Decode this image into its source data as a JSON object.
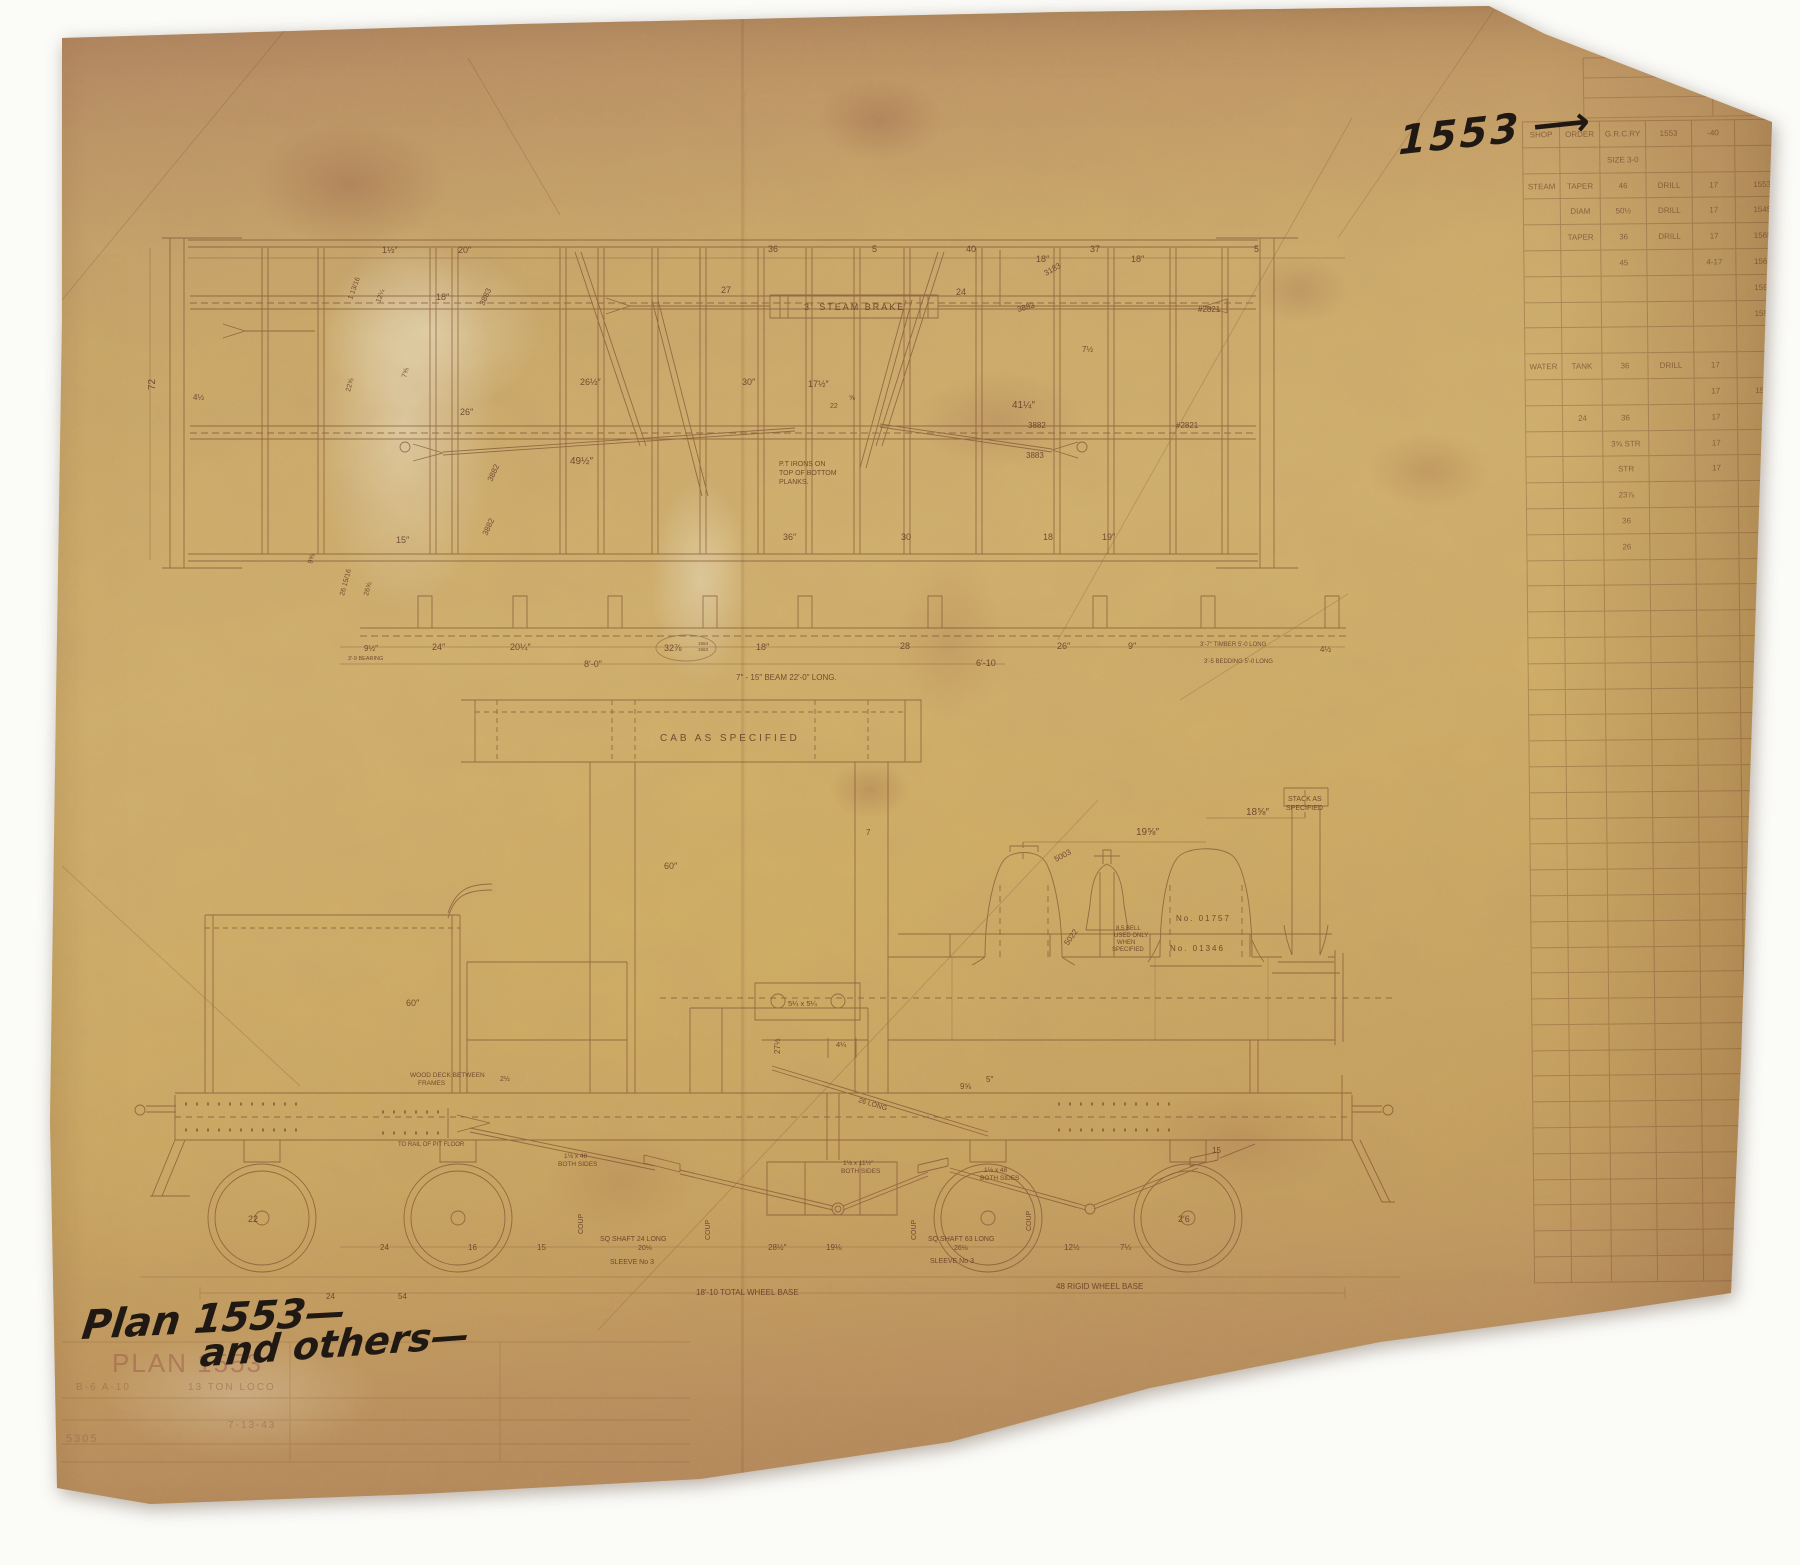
{
  "annotations": {
    "top_right_number": "1553",
    "top_right_arrow": "⟶",
    "bottom_left_line1": "Plan 1553—",
    "bottom_left_line2": "and others—"
  },
  "title_block": {
    "labels": [
      {
        "t": "PLAN 1553",
        "x": 112,
        "y": 1372,
        "s": 26,
        "ls": 6
      },
      {
        "t": "B-6 A-10",
        "x": 76,
        "y": 1390,
        "s": 10
      },
      {
        "t": "13 TON LOCO",
        "x": 188,
        "y": 1390,
        "s": 10,
        "ls": 3
      },
      {
        "t": "7-13-43",
        "x": 228,
        "y": 1428,
        "s": 10
      },
      {
        "t": "5305",
        "x": 66,
        "y": 1442,
        "s": 11
      }
    ]
  },
  "plan_view": {
    "labels": [
      {
        "t": "1½″",
        "x": 382,
        "y": 253
      },
      {
        "t": "20″",
        "x": 458,
        "y": 253
      },
      {
        "t": "36",
        "x": 768,
        "y": 252
      },
      {
        "t": "5",
        "x": 872,
        "y": 252
      },
      {
        "t": "40",
        "x": 966,
        "y": 252
      },
      {
        "t": "37",
        "x": 1090,
        "y": 252
      },
      {
        "t": "5",
        "x": 1254,
        "y": 252
      },
      {
        "t": "18″",
        "x": 436,
        "y": 300
      },
      {
        "t": "27",
        "x": 721,
        "y": 293
      },
      {
        "t": "3′ STEAM BRAKE",
        "x": 804,
        "y": 310,
        "ls": 2
      },
      {
        "t": "24",
        "x": 956,
        "y": 295
      },
      {
        "t": "18″",
        "x": 1036,
        "y": 262
      },
      {
        "t": "18″",
        "x": 1131,
        "y": 262
      },
      {
        "t": "3183",
        "x": 1046,
        "y": 276,
        "r": -30,
        "s": 8
      },
      {
        "t": "3883",
        "x": 484,
        "y": 306,
        "r": -65,
        "s": 8
      },
      {
        "t": "3883",
        "x": 1018,
        "y": 312,
        "r": -15,
        "s": 8
      },
      {
        "t": "#2821",
        "x": 1198,
        "y": 312,
        "s": 8
      },
      {
        "t": "1 13/16",
        "x": 352,
        "y": 300,
        "r": -70,
        "s": 7
      },
      {
        "t": "12¼",
        "x": 380,
        "y": 303,
        "r": -70,
        "s": 7
      },
      {
        "t": "72",
        "x": 155,
        "y": 390,
        "r": -90,
        "s": 10
      },
      {
        "t": "4½",
        "x": 193,
        "y": 400,
        "s": 8
      },
      {
        "t": "7⅝",
        "x": 406,
        "y": 378,
        "r": -75,
        "s": 7
      },
      {
        "t": "22⅝",
        "x": 350,
        "y": 392,
        "r": -75,
        "s": 7
      },
      {
        "t": "26½″",
        "x": 580,
        "y": 385
      },
      {
        "t": "30″",
        "x": 742,
        "y": 385
      },
      {
        "t": "17½″",
        "x": 808,
        "y": 387
      },
      {
        "t": "22",
        "x": 830,
        "y": 408,
        "s": 7
      },
      {
        "t": "⅝",
        "x": 849,
        "y": 400,
        "s": 7
      },
      {
        "t": "7½",
        "x": 1082,
        "y": 352,
        "s": 8
      },
      {
        "t": "26″",
        "x": 460,
        "y": 415
      },
      {
        "t": "49½″",
        "x": 570,
        "y": 464,
        "s": 10
      },
      {
        "t": "41¼″",
        "x": 1012,
        "y": 408,
        "s": 10
      },
      {
        "t": "P.T IRONS ON",
        "x": 779,
        "y": 466,
        "s": 7
      },
      {
        "t": "TOP OF BOTTOM",
        "x": 779,
        "y": 475,
        "s": 7
      },
      {
        "t": "PLANKS.",
        "x": 779,
        "y": 484,
        "s": 7
      },
      {
        "t": "3882",
        "x": 492,
        "y": 482,
        "r": -65,
        "s": 8
      },
      {
        "t": "3882",
        "x": 487,
        "y": 536,
        "r": -65,
        "s": 8
      },
      {
        "t": "3882",
        "x": 1028,
        "y": 428,
        "s": 8
      },
      {
        "t": "3883",
        "x": 1026,
        "y": 458,
        "s": 8
      },
      {
        "t": "#2821",
        "x": 1176,
        "y": 428,
        "s": 8
      },
      {
        "t": "15″",
        "x": 396,
        "y": 543
      },
      {
        "t": "36″",
        "x": 783,
        "y": 540
      },
      {
        "t": "30",
        "x": 901,
        "y": 540
      },
      {
        "t": "18",
        "x": 1043,
        "y": 540
      },
      {
        "t": "19″",
        "x": 1102,
        "y": 540
      },
      {
        "t": "9⅝",
        "x": 312,
        "y": 564,
        "r": -75,
        "s": 7
      },
      {
        "t": "26 15/16",
        "x": 344,
        "y": 596,
        "r": -75,
        "s": 7
      },
      {
        "t": "26⅝",
        "x": 368,
        "y": 596,
        "r": -75,
        "s": 7
      },
      {
        "t": "3′-9 BEARING",
        "x": 348,
        "y": 660,
        "s": 5.5
      },
      {
        "t": "9½″",
        "x": 364,
        "y": 651,
        "s": 8
      },
      {
        "t": "24″",
        "x": 432,
        "y": 650
      },
      {
        "t": "20¼″",
        "x": 510,
        "y": 650
      },
      {
        "t": "8′-0″",
        "x": 584,
        "y": 667
      },
      {
        "t": "32⅞",
        "x": 664,
        "y": 651
      },
      {
        "t": "1554",
        "x": 698,
        "y": 645,
        "s": 4.5
      },
      {
        "t": "1563",
        "x": 698,
        "y": 651,
        "s": 4.5
      },
      {
        "t": "18″",
        "x": 756,
        "y": 650
      },
      {
        "t": "28",
        "x": 900,
        "y": 649
      },
      {
        "t": "6′-10",
        "x": 976,
        "y": 666
      },
      {
        "t": "26″",
        "x": 1057,
        "y": 649
      },
      {
        "t": "9″",
        "x": 1128,
        "y": 649
      },
      {
        "t": "3′-7″ TIMBER 5′-0 LONG",
        "x": 1200,
        "y": 646,
        "s": 6
      },
      {
        "t": "3′-5 BEDDING 5′-0 LONG",
        "x": 1204,
        "y": 663,
        "s": 6
      },
      {
        "t": "4½",
        "x": 1320,
        "y": 652,
        "s": 8
      },
      {
        "t": "7″ - 15″ BEAM 22′-0″ LONG.",
        "x": 736,
        "y": 680,
        "s": 8
      }
    ]
  },
  "elevation": {
    "labels": [
      {
        "t": "CAB AS SPECIFIED",
        "x": 660,
        "y": 741,
        "s": 10,
        "ls": 3
      },
      {
        "t": "60″",
        "x": 664,
        "y": 869
      },
      {
        "t": "7",
        "x": 866,
        "y": 835,
        "s": 8
      },
      {
        "t": "STACK AS",
        "x": 1288,
        "y": 801,
        "s": 7
      },
      {
        "t": "SPECIFIED",
        "x": 1286,
        "y": 810,
        "s": 7
      },
      {
        "t": "19⅝″",
        "x": 1136,
        "y": 835,
        "s": 10
      },
      {
        "t": "18⅝″",
        "x": 1246,
        "y": 815,
        "s": 10
      },
      {
        "t": "5003",
        "x": 1056,
        "y": 862,
        "r": -28,
        "s": 8
      },
      {
        "t": "5022",
        "x": 1068,
        "y": 946,
        "r": -55,
        "s": 8
      },
      {
        "t": "8.5 BELL",
        "x": 1116,
        "y": 930,
        "s": 6
      },
      {
        "t": "USED ONLY",
        "x": 1114,
        "y": 937,
        "s": 6
      },
      {
        "t": "WHEN",
        "x": 1117,
        "y": 944,
        "s": 6
      },
      {
        "t": "SPECIFIED",
        "x": 1112,
        "y": 951,
        "s": 6
      },
      {
        "t": "No. 01757",
        "x": 1176,
        "y": 921,
        "s": 8,
        "ls": 2
      },
      {
        "t": "No. 01346",
        "x": 1170,
        "y": 951,
        "s": 8,
        "ls": 2
      },
      {
        "t": "27½",
        "x": 780,
        "y": 1054,
        "r": -90,
        "s": 8
      },
      {
        "t": "60″",
        "x": 406,
        "y": 1006
      },
      {
        "t": "WOOD DECK BETWEEN",
        "x": 410,
        "y": 1077,
        "s": 6.5
      },
      {
        "t": "FRAMES",
        "x": 418,
        "y": 1085,
        "s": 6.5
      },
      {
        "t": "2½",
        "x": 500,
        "y": 1081,
        "s": 7
      },
      {
        "t": "5¼ x 5¼",
        "x": 788,
        "y": 1006,
        "s": 7.5
      },
      {
        "t": "4¼",
        "x": 836,
        "y": 1047,
        "s": 7.5
      },
      {
        "t": "9⅝",
        "x": 960,
        "y": 1089,
        "s": 8
      },
      {
        "t": "5″",
        "x": 986,
        "y": 1082,
        "s": 8
      },
      {
        "t": "26 LONG",
        "x": 858,
        "y": 1102,
        "r": 17,
        "s": 7
      },
      {
        "t": "TO RAIL OF PIT FLOOR",
        "x": 398,
        "y": 1146,
        "s": 6
      },
      {
        "t": "1⅛ x 48",
        "x": 564,
        "y": 1158,
        "s": 6.5
      },
      {
        "t": "BOTH SIDES",
        "x": 558,
        "y": 1166,
        "s": 6.5
      },
      {
        "t": "1⅛ x 11½″",
        "x": 843,
        "y": 1165,
        "s": 6.5
      },
      {
        "t": "BOTH SIDES",
        "x": 841,
        "y": 1173,
        "s": 6.5
      },
      {
        "t": "1⅛ x 48",
        "x": 984,
        "y": 1172,
        "s": 6.5
      },
      {
        "t": "BOTH SIDES",
        "x": 980,
        "y": 1180,
        "s": 6.5
      },
      {
        "t": "COUP",
        "x": 583,
        "y": 1234,
        "r": -90,
        "s": 7
      },
      {
        "t": "COUP",
        "x": 710,
        "y": 1240,
        "r": -90,
        "s": 7
      },
      {
        "t": "COUP",
        "x": 916,
        "y": 1240,
        "r": -90,
        "s": 7
      },
      {
        "t": "COUP",
        "x": 1031,
        "y": 1231,
        "r": -90,
        "s": 7
      },
      {
        "t": "24",
        "x": 380,
        "y": 1250,
        "s": 8
      },
      {
        "t": "16",
        "x": 468,
        "y": 1250,
        "s": 8
      },
      {
        "t": "15",
        "x": 537,
        "y": 1250,
        "s": 8
      },
      {
        "t": "SQ SHAFT 24 LONG",
        "x": 600,
        "y": 1241,
        "s": 7
      },
      {
        "t": "20⅛",
        "x": 638,
        "y": 1250,
        "s": 7
      },
      {
        "t": "SLEEVE No 3",
        "x": 610,
        "y": 1264,
        "s": 7
      },
      {
        "t": "28½″",
        "x": 768,
        "y": 1250,
        "s": 8
      },
      {
        "t": "19⅛",
        "x": 826,
        "y": 1250,
        "s": 8
      },
      {
        "t": "SQ SHAFT 63 LONG",
        "x": 928,
        "y": 1241,
        "s": 7
      },
      {
        "t": "26⅛",
        "x": 954,
        "y": 1250,
        "s": 7
      },
      {
        "t": "SLEEVE No 3",
        "x": 930,
        "y": 1263,
        "s": 7
      },
      {
        "t": "12½",
        "x": 1064,
        "y": 1250,
        "s": 8
      },
      {
        "t": "7¼",
        "x": 1120,
        "y": 1250,
        "s": 8
      },
      {
        "t": "22",
        "x": 248,
        "y": 1222,
        "s": 9
      },
      {
        "t": "2′6",
        "x": 1178,
        "y": 1222,
        "s": 9
      },
      {
        "t": "15",
        "x": 1212,
        "y": 1153,
        "s": 8
      },
      {
        "t": "24",
        "x": 326,
        "y": 1299,
        "s": 8
      },
      {
        "t": "54",
        "x": 398,
        "y": 1299,
        "s": 8
      },
      {
        "t": "18′-10 TOTAL WHEEL BASE",
        "x": 696,
        "y": 1295,
        "s": 8
      },
      {
        "t": "48 RIGID WHEEL BASE",
        "x": 1056,
        "y": 1289,
        "s": 8
      }
    ]
  },
  "side_table": {
    "col_widths": [
      38,
      40,
      46,
      46,
      43,
      54
    ],
    "row_height": 25.8,
    "total_rows": 45,
    "rows": [
      [
        "SHOP",
        "ORDER",
        "G.R.C.RY",
        "1553",
        "-40",
        ""
      ],
      [
        "",
        "",
        "SIZE 3-0",
        "",
        "",
        ""
      ],
      [
        "STEAM",
        "TAPER",
        "46",
        "DRILL",
        "17",
        "1553"
      ],
      [
        "",
        "DIAM",
        "50½",
        "DRILL",
        "17",
        "1545"
      ],
      [
        "",
        "TAPER",
        "36",
        "DRILL",
        "17",
        "1565"
      ],
      [
        "",
        "",
        "45",
        "",
        "4-17",
        "1561"
      ],
      [
        "",
        "",
        "",
        "",
        "",
        "1592"
      ],
      [
        "",
        "",
        "",
        "",
        "",
        "1593"
      ],
      [
        "",
        "",
        "",
        "",
        "",
        ""
      ],
      [
        "WATER",
        "TANK",
        "36",
        "DRILL",
        "17",
        ""
      ],
      [
        "",
        "",
        "",
        "",
        "17",
        "1543"
      ],
      [
        "",
        "24",
        "36",
        "",
        "17",
        ""
      ],
      [
        "",
        "",
        "3⅝ STR",
        "",
        "17",
        ""
      ],
      [
        "",
        "",
        "STR",
        "",
        "17",
        ""
      ],
      [
        "",
        "",
        "23⅞",
        "",
        "",
        ""
      ],
      [
        "",
        "",
        "36",
        "",
        "",
        ""
      ],
      [
        "",
        "",
        "26",
        "",
        "",
        ""
      ]
    ],
    "mini": {
      "col_widths": [
        130,
        82
      ],
      "rows": [
        [
          "",
          ""
        ],
        [
          "",
          ""
        ],
        [
          "",
          ""
        ]
      ]
    }
  }
}
